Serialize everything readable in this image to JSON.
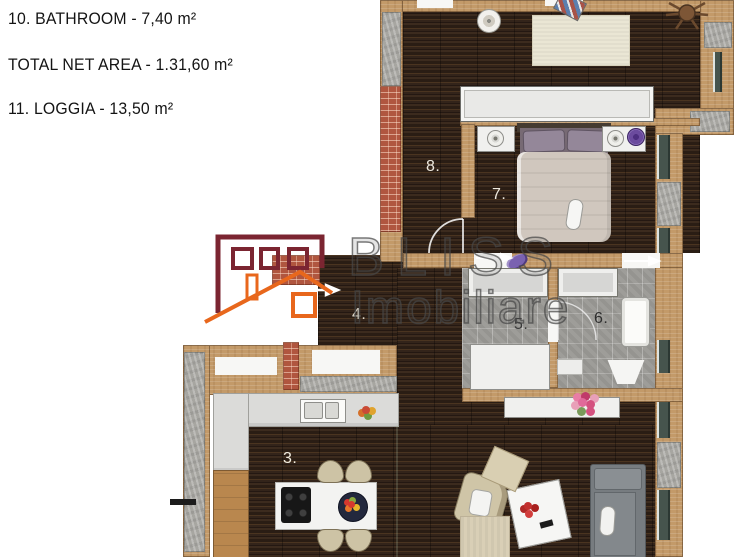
{
  "area_labels": [
    "10. BATHROOM - 7,40 m²",
    "TOTAL NET AREA - 1.31,60 m²",
    "11. LOGGIA - 13,50 m²"
  ],
  "logo": {
    "brand": "BLISS",
    "subtitle": "Imobiliare"
  },
  "rooms": [
    {
      "id": "kitchen-living-room",
      "label": "3."
    },
    {
      "id": "hallway",
      "label": "4."
    },
    {
      "id": "dressing",
      "label": "5."
    },
    {
      "id": "bathroom",
      "label": "6."
    },
    {
      "id": "bedroom",
      "label": "7."
    },
    {
      "id": "corridor",
      "label": "8."
    }
  ],
  "colors": {
    "wall_tan": "#c39a69",
    "wall_concrete": "#a7a6a1",
    "wall_brick": "#b0563f",
    "floor_wood": "#342418",
    "floor_tile": "#9e9d99",
    "window_frame": "#46544d",
    "logo_maroon": "#7b2531",
    "logo_orange": "#e8671c",
    "logo_text_gray": "#484848"
  }
}
